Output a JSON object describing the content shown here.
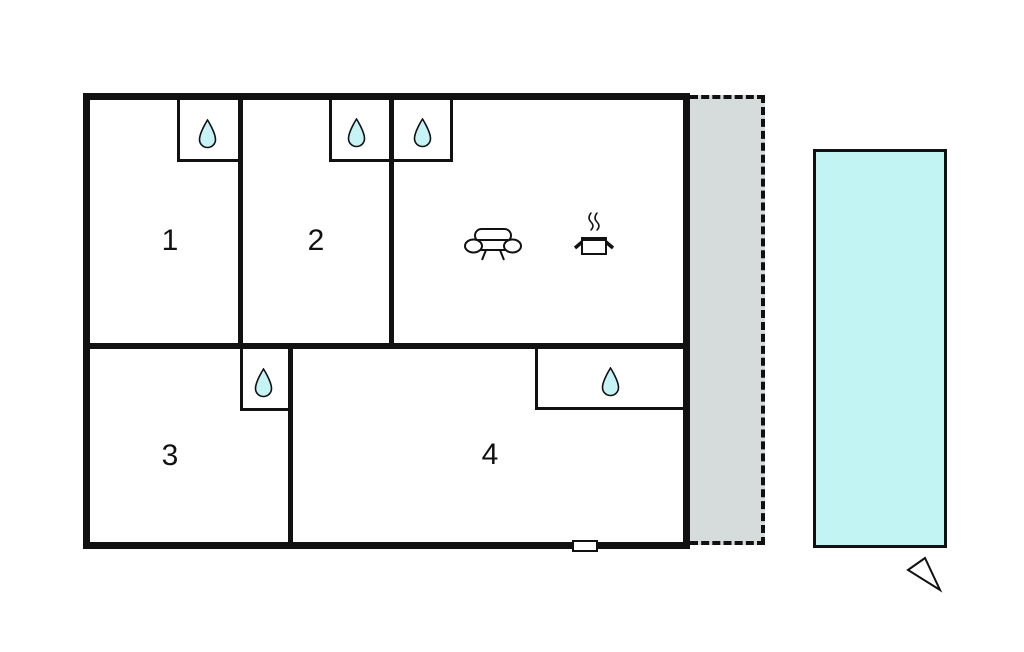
{
  "diagram": {
    "type": "floor-plan",
    "background": "#ffffff"
  },
  "colors": {
    "wall": "#111111",
    "water_drop": "#c6f3f5",
    "pool": "#c2f4f4",
    "terrace": "#d6dcdb"
  },
  "rooms": [
    {
      "label": "1",
      "icons": [
        "water-drop-icon"
      ]
    },
    {
      "label": "2",
      "icons": [
        "water-drop-icon"
      ]
    },
    {
      "label": "3",
      "icons": [
        "water-drop-icon"
      ]
    },
    {
      "label": "4",
      "icons": [
        "water-drop-icon"
      ]
    }
  ],
  "living_area": {
    "icons": [
      "water-drop-icon",
      "sofa-icon",
      "cooking-pot-icon"
    ]
  },
  "outdoor": {
    "terrace_style": "dashed-outline",
    "pool": "swimming-pool",
    "orientation_marker": "compass-arrow-icon"
  }
}
